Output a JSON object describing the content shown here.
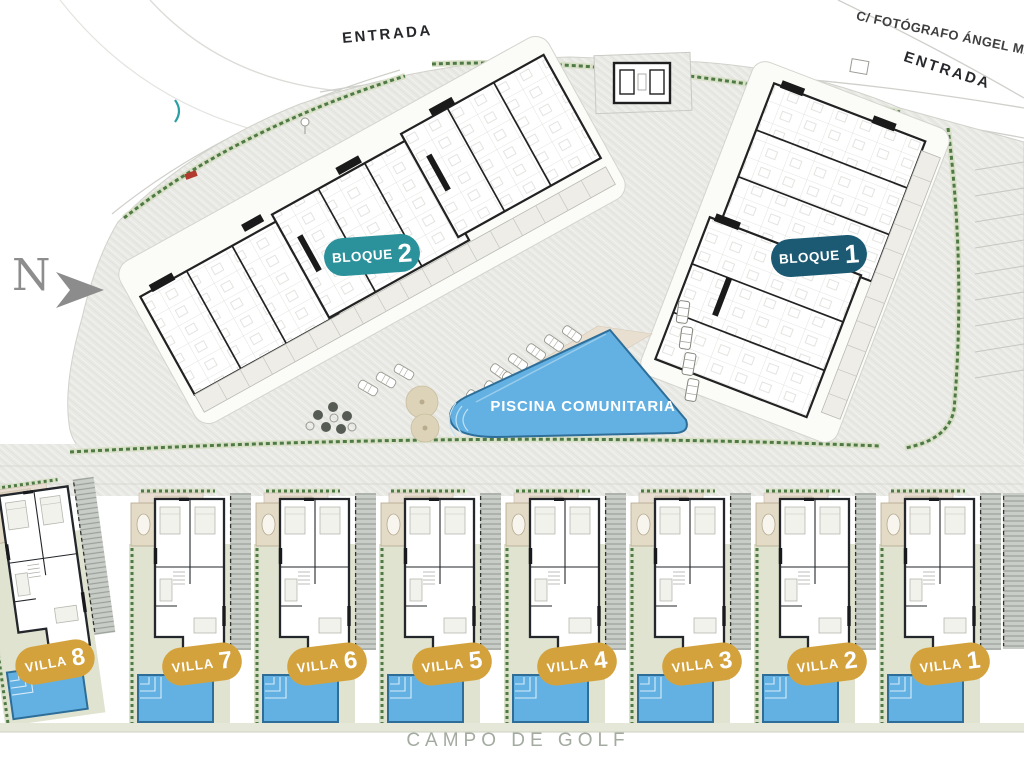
{
  "north_label": "N",
  "street_label": "C/ FOTÓGRAFO ÁNGEL MARTÍN",
  "entrances": {
    "top": "ENTRADA",
    "right": "ENTRADA"
  },
  "bloques": [
    {
      "label": "BLOQUE",
      "number": "2",
      "badge_color": "#2b929b"
    },
    {
      "label": "BLOQUE",
      "number": "1",
      "badge_color": "#1c5a73"
    }
  ],
  "pool_label": "PISCINA COMUNITARIA",
  "golf_label": "CAMPO DE GOLF",
  "villas": [
    {
      "label": "VILLA",
      "number": "8"
    },
    {
      "label": "VILLA",
      "number": "7"
    },
    {
      "label": "VILLA",
      "number": "6"
    },
    {
      "label": "VILLA",
      "number": "5"
    },
    {
      "label": "VILLA",
      "number": "4"
    },
    {
      "label": "VILLA",
      "number": "3"
    },
    {
      "label": "VILLA",
      "number": "2"
    },
    {
      "label": "VILLA",
      "number": "1"
    }
  ],
  "colors": {
    "villa_badge": "#d4a23c",
    "bloque2_badge": "#2b929b",
    "bloque1_badge": "#1c5a73",
    "pool_water": "#63b1e2",
    "entrance_arrow": "#1e4878",
    "hedge_green": "#4f7a45"
  }
}
